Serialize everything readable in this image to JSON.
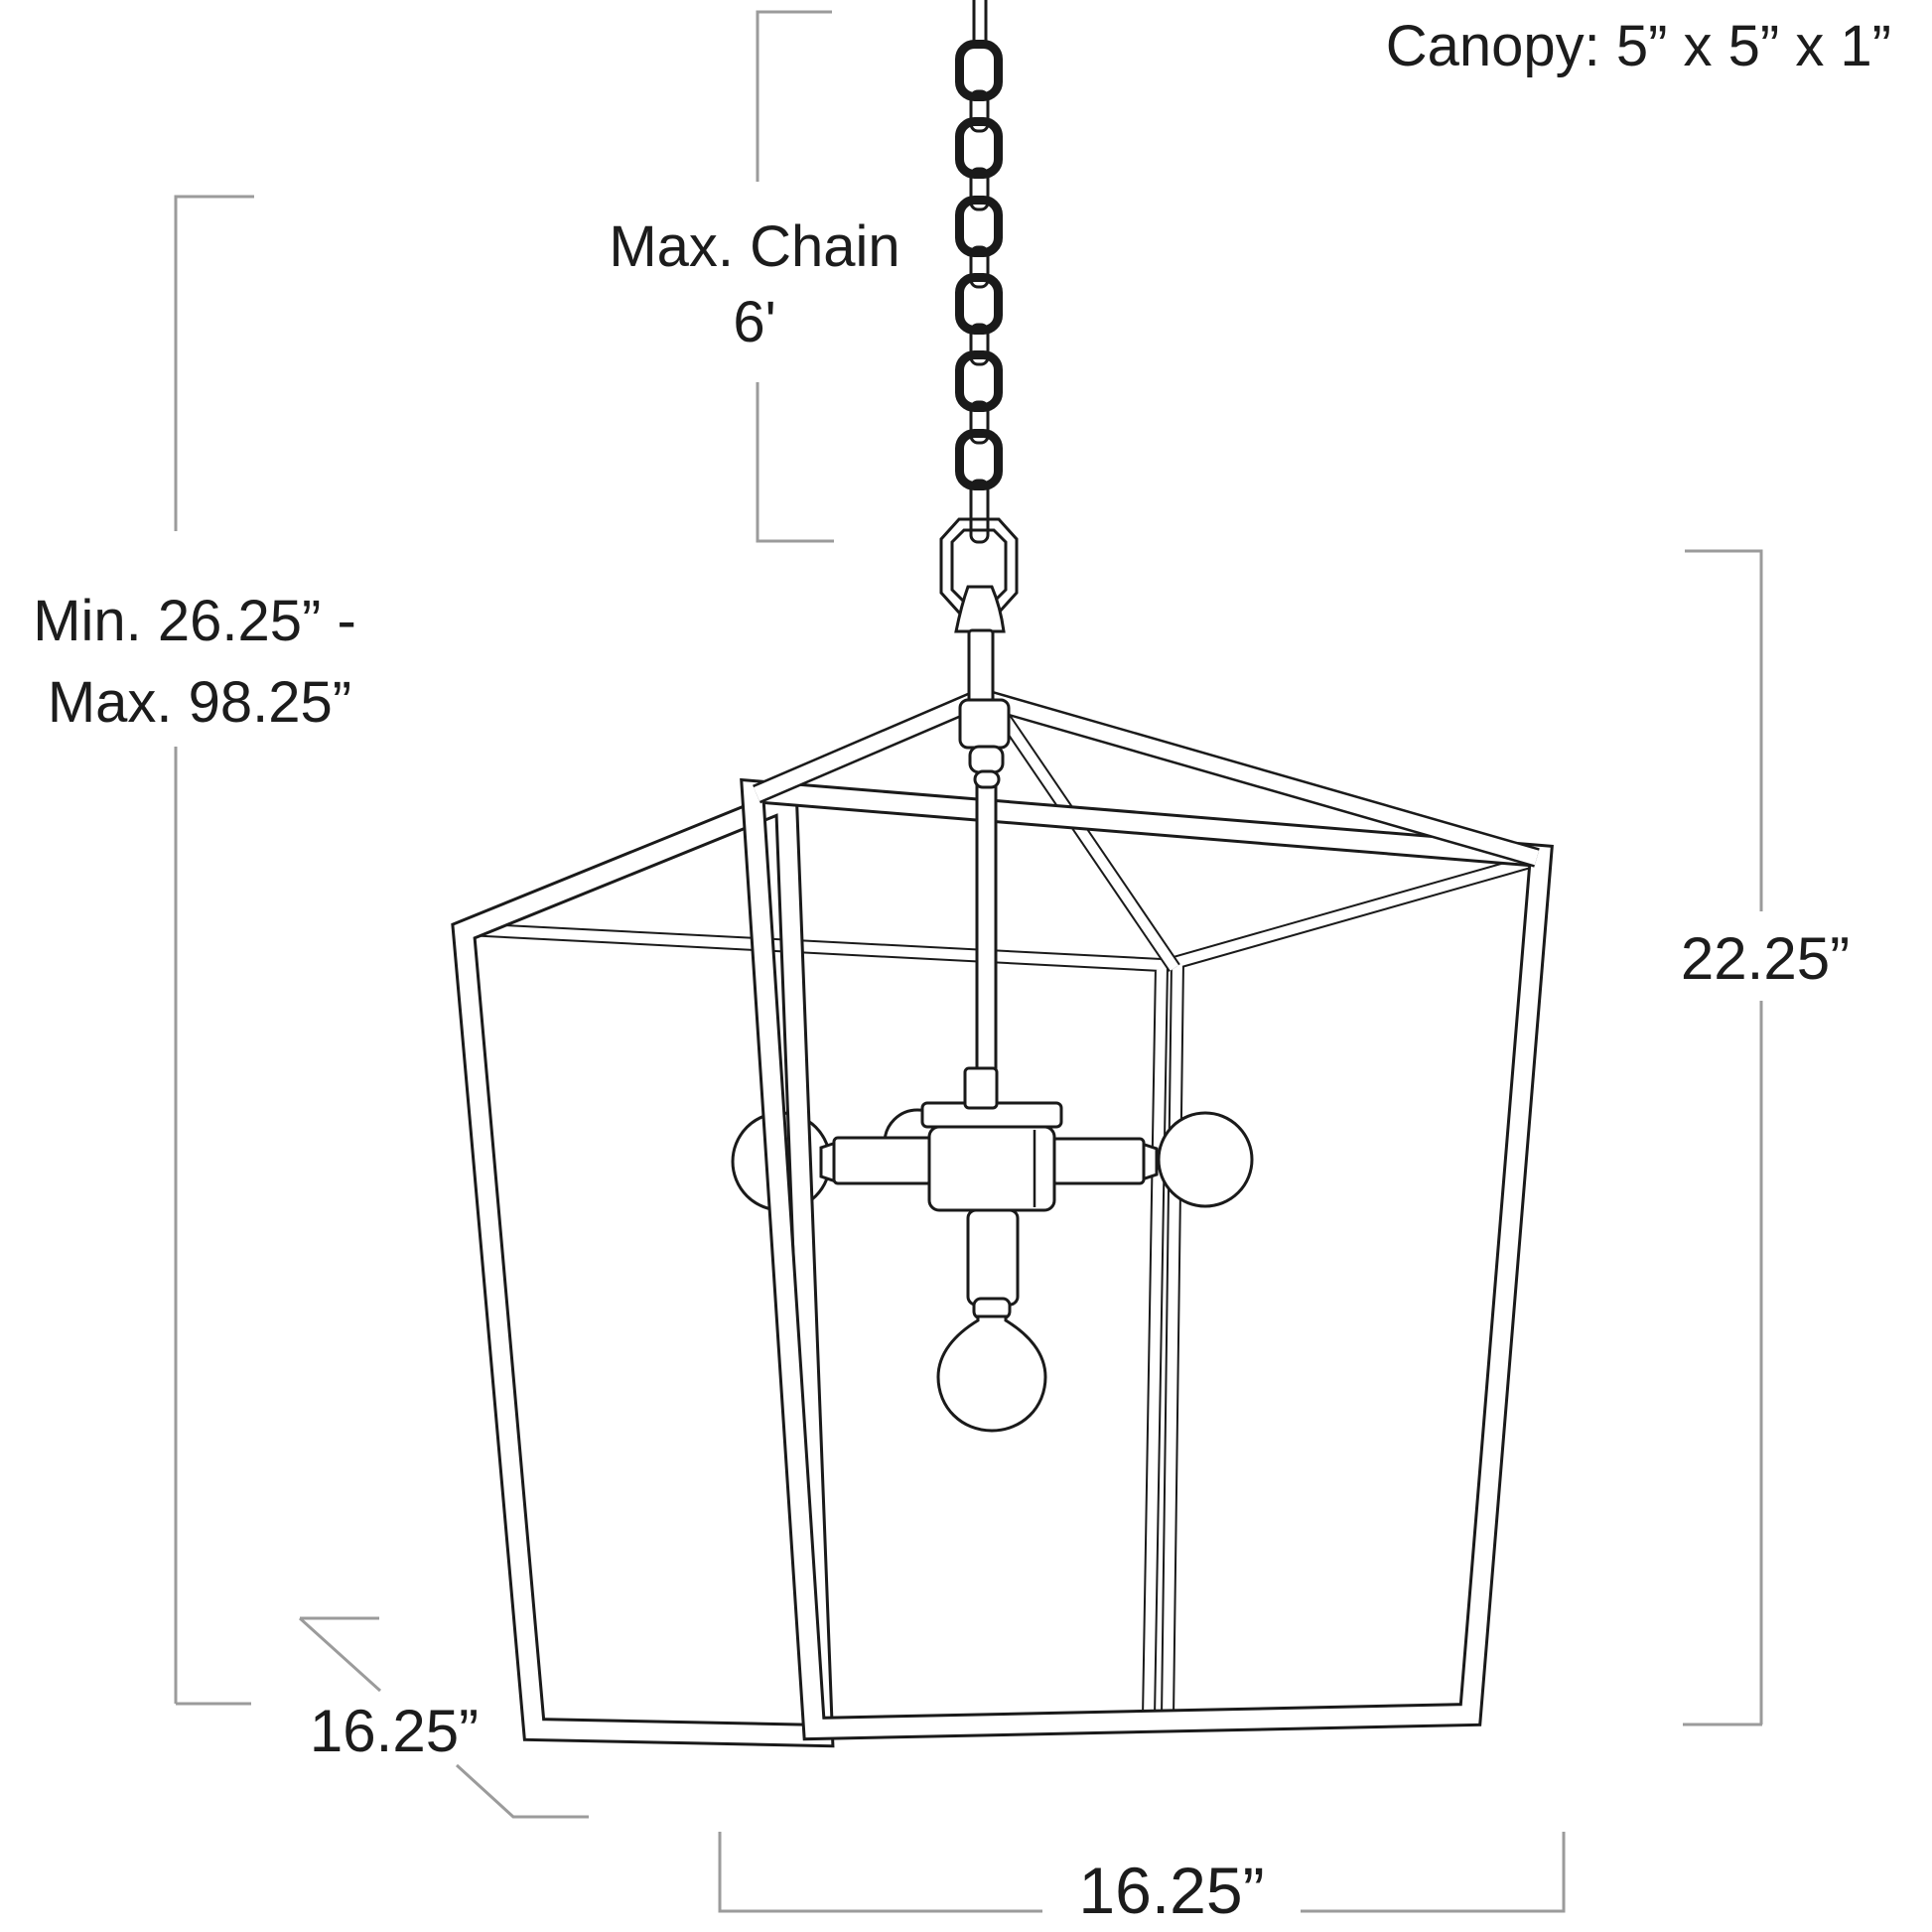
{
  "figure": "pendant-light-dimension-diagram",
  "colors": {
    "background": "#ffffff",
    "drawing_line": "#1a1a1a",
    "dimension_line": "#9b9b9b",
    "text": "#1c1c1c"
  },
  "labels": {
    "canopy": "Canopy: 5” x 5” x 1”",
    "max_chain_line1": "Max. Chain",
    "max_chain_line2": "6'",
    "overall_line1": "Min. 26.25” -",
    "overall_line2": "Max. 98.25”",
    "height": "22.25”",
    "width": "16.25”",
    "depth": "16.25”"
  },
  "dimensions": {
    "canopy": "5” x 5” x 1”",
    "max_chain": "6'",
    "overall_min": "26.25”",
    "overall_max": "98.25”",
    "cage_height": "22.25”",
    "cage_width": "16.25”",
    "cage_depth": "16.25”"
  }
}
